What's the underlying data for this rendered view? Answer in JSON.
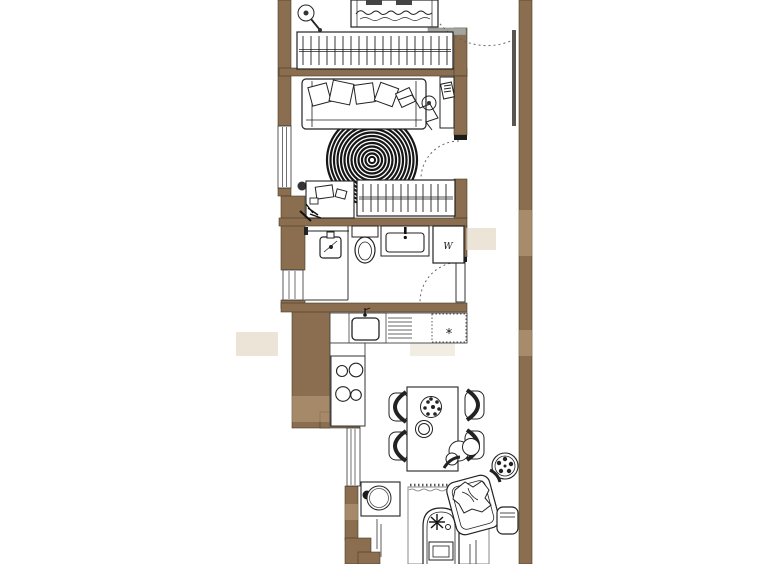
{
  "document": {
    "type": "apartment floor plan drawing",
    "background": "#ffffff",
    "orientation": "tall narrow unit, plan cropped at top and bottom edges"
  },
  "palette": {
    "wall_fill": "#8a6e4f",
    "line": "#222222",
    "secondary_line": "#555555",
    "light_gray_wall": "#a5a5a0",
    "watermark_tan": "#ddd2bd",
    "watermark_on_wall": "#bfa482"
  },
  "appliance_labels": {
    "washing_machine": "W",
    "dishwasher": "*"
  },
  "rooms": [
    {
      "name": "bedroom",
      "position": "top",
      "furniture": [
        "bed (cropped by image edge)",
        "floor lamp",
        "wardrobe with hanging rail",
        "entrance door swing"
      ]
    },
    {
      "name": "living-room",
      "position": "upper-middle",
      "furniture": [
        "sofa with cushions and throw",
        "small side table",
        "round spiral rug",
        "desk with chair",
        "second wardrobe",
        "door swing"
      ]
    },
    {
      "name": "bathroom",
      "position": "middle",
      "furniture": [
        "shower with rail",
        "toilet",
        "washbasin with tap",
        "washing machine",
        "door swing"
      ]
    },
    {
      "name": "kitchen-dining",
      "position": "lower-middle",
      "furniture": [
        "L-shaped counter",
        "sink with tap",
        "draining board",
        "dishwasher",
        "stove with 4 burners",
        "dining table",
        "4 chairs",
        "table plant",
        "bowl",
        "floor plant"
      ]
    },
    {
      "name": "lounge",
      "position": "bottom (cropped by image edge)",
      "furniture": [
        "media side table",
        "fringed rug",
        "chaise lounge with cushion",
        "armchair with throw",
        "small side table"
      ]
    }
  ],
  "windows_count": 3,
  "hallway": {
    "present": true,
    "side": "right"
  },
  "watermark": {
    "present": true,
    "legible": false
  }
}
